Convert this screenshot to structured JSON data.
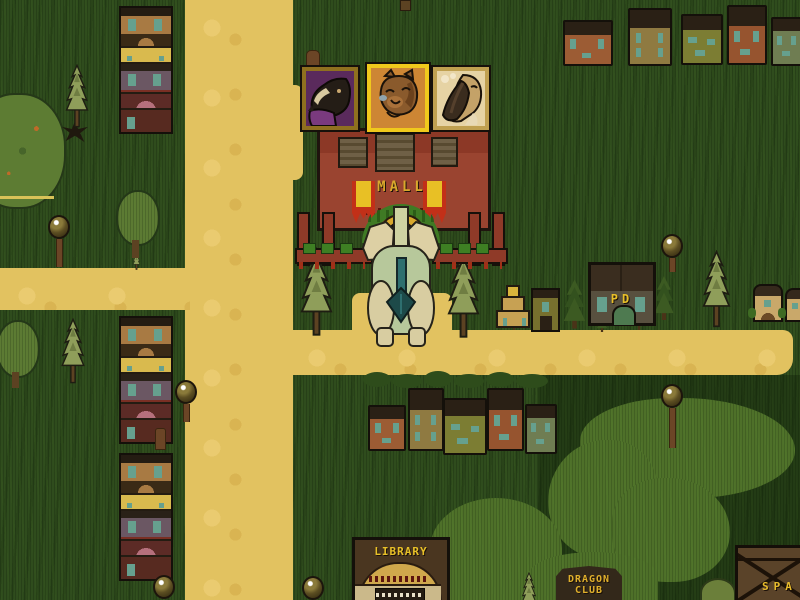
{
  "scene": {
    "name": "pixel-town-overworld"
  },
  "party": [
    {
      "id": "dark-dragon",
      "frame_style": "dark-gold",
      "active": false,
      "bg": "#5a2a5c"
    },
    {
      "id": "brown-cub",
      "frame_style": "bright-gold",
      "active": true,
      "bg": "#cd8634"
    },
    {
      "id": "bird",
      "frame_style": "pale-gold",
      "active": false,
      "bg": "#e6d3a4"
    }
  ],
  "player": {
    "id": "pale-green-dragon",
    "location": "mall-entrance"
  },
  "labels": {
    "mall": "MALL",
    "pd": "PD",
    "library": "LIBRARY",
    "dragon_club_line1": "DRAGON",
    "dragon_club_line2": "CLUB",
    "spa": "SPA"
  },
  "palette": {
    "grass": "#2f4c1d",
    "grass_moss": "#4e7029",
    "road": "#e2c260",
    "mall_wall": "#96402c",
    "gold_text": "#d9a82c",
    "banner_yellow": "#e8c025",
    "banner_red": "#c23018",
    "window_teal": "#66a08e",
    "roof_dark": "#2a2015",
    "frame_active": "#f0c91c",
    "frame_idle": "#8f701f",
    "tail_teal": "#2e6f6f",
    "house_rust": "#9c5c34",
    "house_khaki": "#8f7a41",
    "house_olive": "#7c7d33",
    "house_sage": "#6f7d52"
  }
}
